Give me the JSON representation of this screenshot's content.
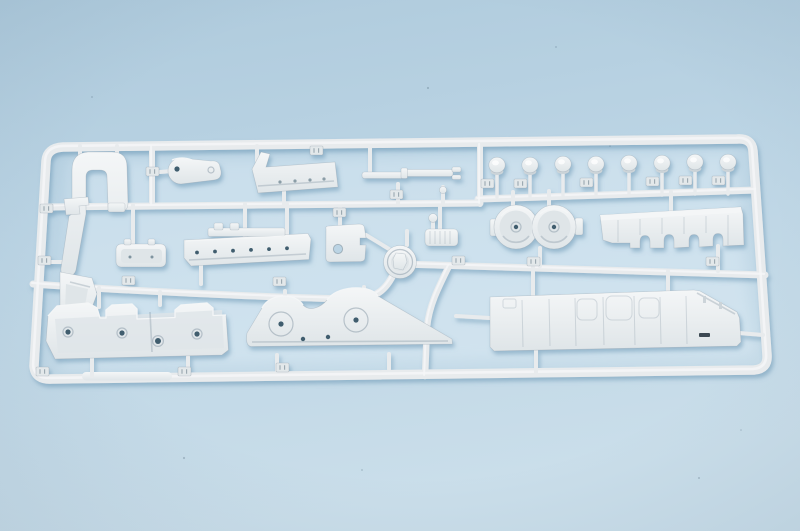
{
  "scene": {
    "type": "photograph",
    "subject": "plastic model kit sprue",
    "description": "Light gray injection-molded model kit sprue (parts runner) holding ship-model parts, photographed on a pale blue surface",
    "background_surface": "pale blue",
    "sprue_material": "light gray polystyrene",
    "visible_text": ""
  },
  "colors": {
    "bg_top": "#aecadc",
    "bg_mid": "#bbd4e4",
    "bg_bottom": "#cadeea",
    "plastic": "#e8ebed",
    "plastic_highlight": "#f4f6f7",
    "plastic_shadow": "#ccd4d9",
    "plastic_recess": "#dfe5e8",
    "cast_shadow": "#5f8fae",
    "hole": "#3f5d6e",
    "tag": "#e3e8ea"
  },
  "parts": {
    "round_fittings_count": 8,
    "number_tags_count": 20,
    "items": [
      {
        "id": "sprue-frame",
        "label": "outer runner frame"
      },
      {
        "id": "davit-frame",
        "label": "U-shaped davit frame with lower boot"
      },
      {
        "id": "lever-arm",
        "label": "teardrop lever plate with holes"
      },
      {
        "id": "angled-platform",
        "label": "platform with upturned end tab"
      },
      {
        "id": "yardarm-rod",
        "label": "segmented yard rod"
      },
      {
        "id": "round-fittings-row",
        "label": "row of eight round fittings"
      },
      {
        "id": "twin-tub",
        "label": "figure-eight twin gun tub"
      },
      {
        "id": "notched-bulkhead",
        "label": "bulkhead with notched lower edge"
      },
      {
        "id": "plate-with-porthole",
        "label": "small plate with round hole"
      },
      {
        "id": "turret-ring",
        "label": "round turret ring"
      },
      {
        "id": "ribbed-raft",
        "label": "small ribbed raft"
      },
      {
        "id": "small-tray",
        "label": "small boat tray"
      },
      {
        "id": "long-tray",
        "label": "long hull tray with portholes"
      },
      {
        "id": "casemate-deck",
        "label": "stepped casemate deck with holes"
      },
      {
        "id": "superstructure-wing",
        "label": "tapered superstructure side with round bases"
      },
      {
        "id": "main-deck-strip",
        "label": "long deck strip with hatches"
      }
    ]
  }
}
